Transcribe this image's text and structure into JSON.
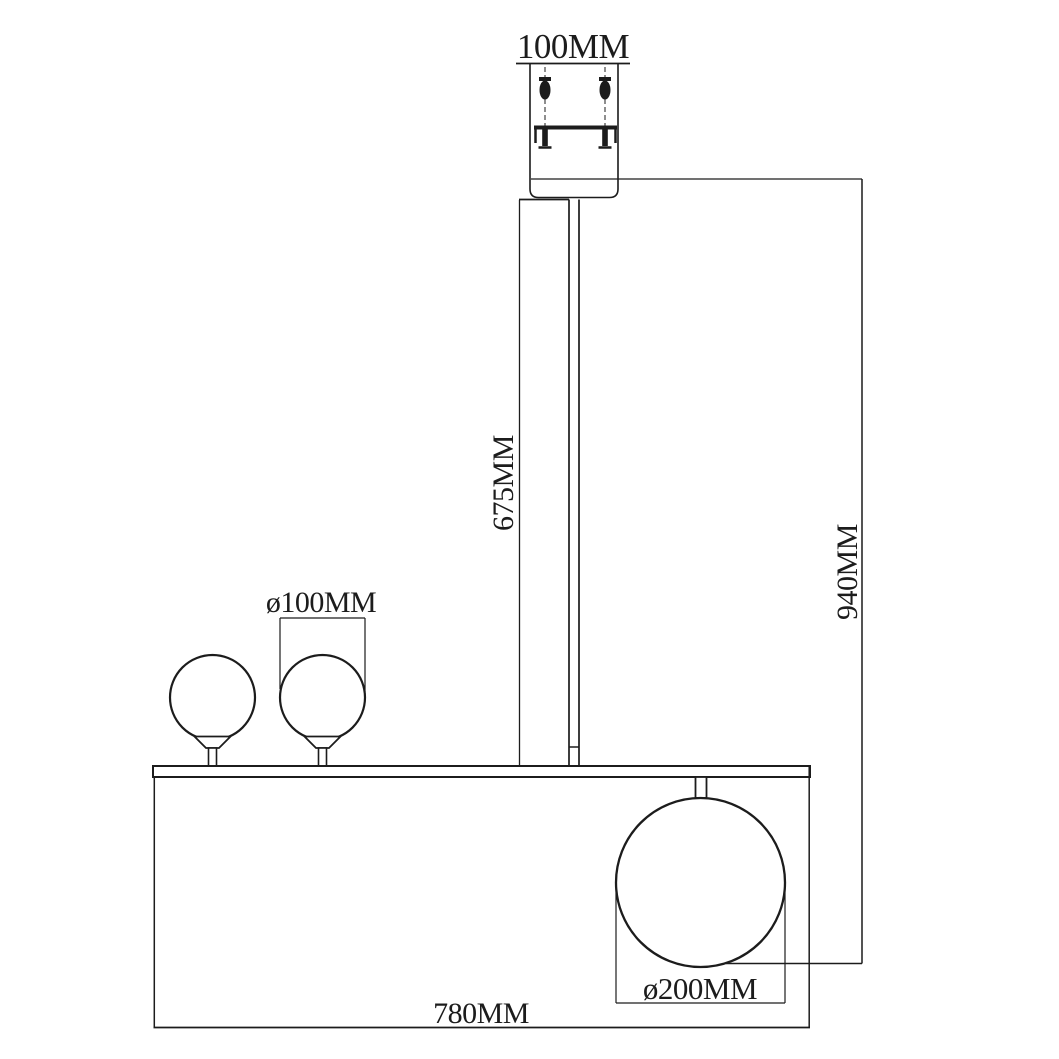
{
  "page": {
    "background": "#ffffff",
    "line_color": "#1c1c1c"
  },
  "drawing": {
    "type": "pendant-lamp-dimension-drawing",
    "labels": {
      "canopy_width": "100MM",
      "rod_length": "675MM",
      "overall_height": "940MM",
      "small_globe_diameter": "ø100MM",
      "large_globe_diameter": "ø200MM",
      "fixture_width": "780MM"
    }
  }
}
